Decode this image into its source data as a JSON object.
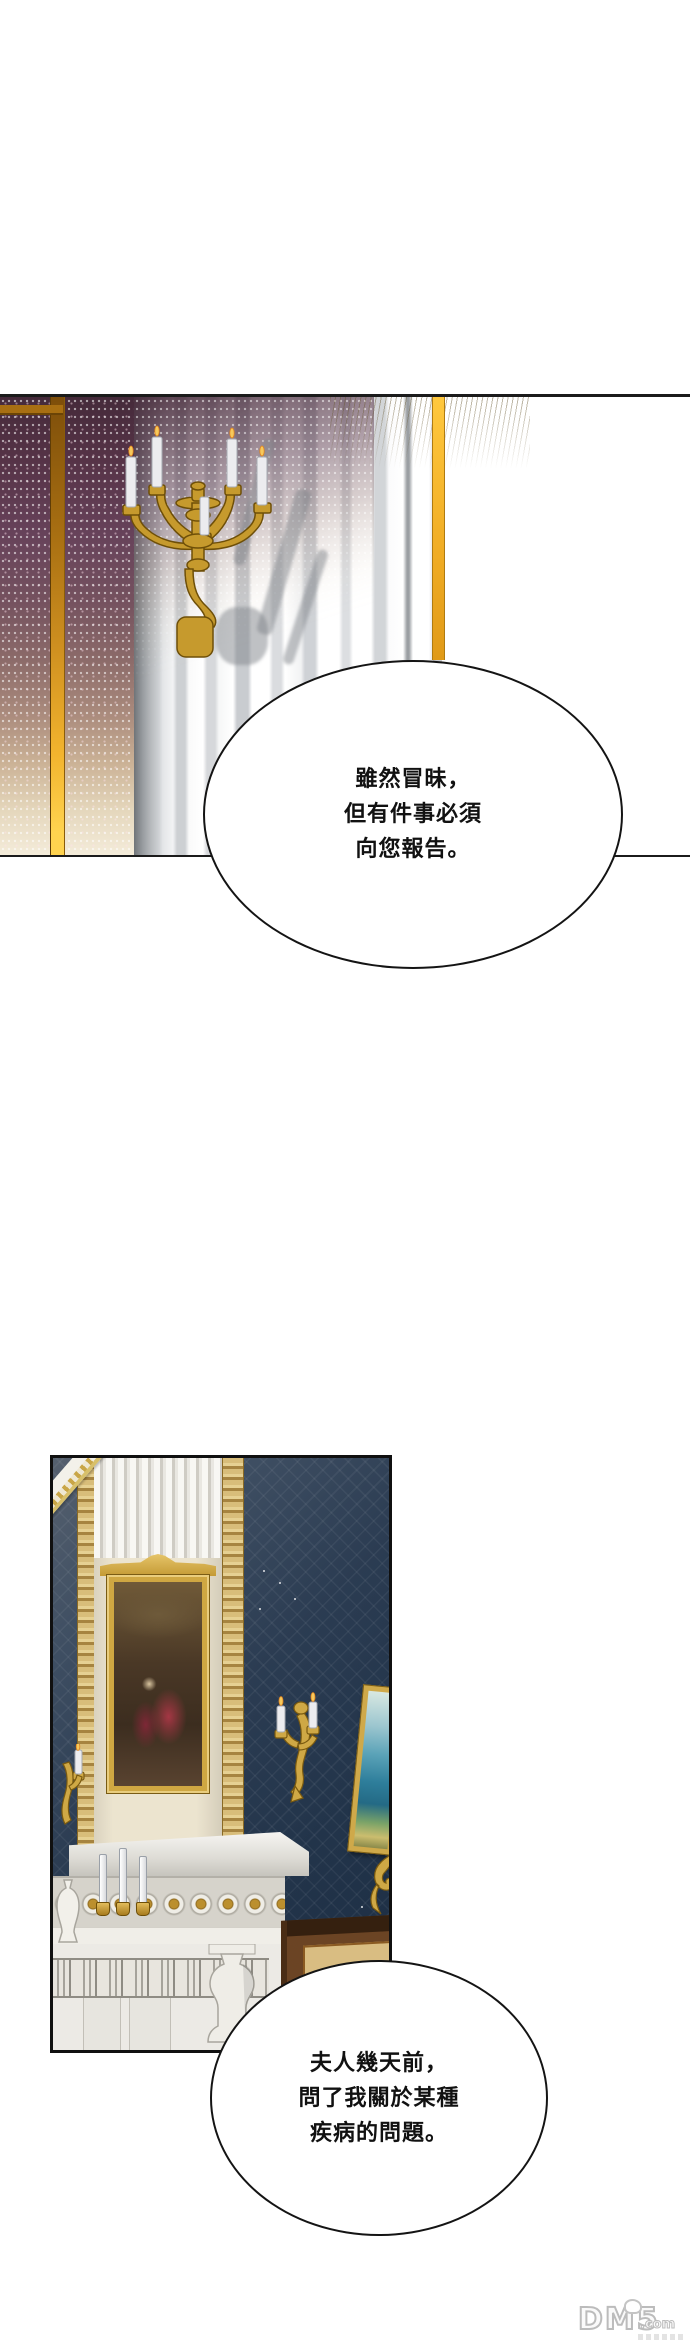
{
  "speech_bubbles": [
    {
      "lines": [
        "雖然冒昧，",
        "但有件事必須",
        "向您報告。"
      ]
    },
    {
      "lines": [
        "夫人幾天前，",
        "問了我關於某種",
        "疾病的問題。"
      ]
    }
  ],
  "watermark": {
    "logo": "DM5",
    "suffix": ".com"
  },
  "scene": {
    "panel1": {
      "objects": [
        "sparkling-purple-wallpaper",
        "gold-wall-trim",
        "gold-candelabra-sconce-with-white-candles",
        "striped-light-wall",
        "gold-vertical-stripe"
      ],
      "colors": {
        "wallpaper_top": "#563347",
        "wallpaper_fade": "#e4d6bb",
        "gold_trim": "#f2b42e",
        "candelabra_gold": "#c69a2d",
        "stripe_gray": "#cdd0d3"
      }
    },
    "panel2": {
      "objects": [
        "navy-damask-wall",
        "white-fluted-chimney-breast",
        "gold-framed-figure-painting",
        "marble-mantel-with-rosette-frieze",
        "mantel-candles",
        "wall-sconces",
        "tilted-seascape-painting",
        "wooden-cabinet"
      ],
      "colors": {
        "wall_navy": "#2b3c52",
        "marble": "#eceae5",
        "frame_gold": "#cfa742",
        "cabinet_wood": "#6b4424",
        "drawer": "#d9bd82"
      }
    }
  }
}
